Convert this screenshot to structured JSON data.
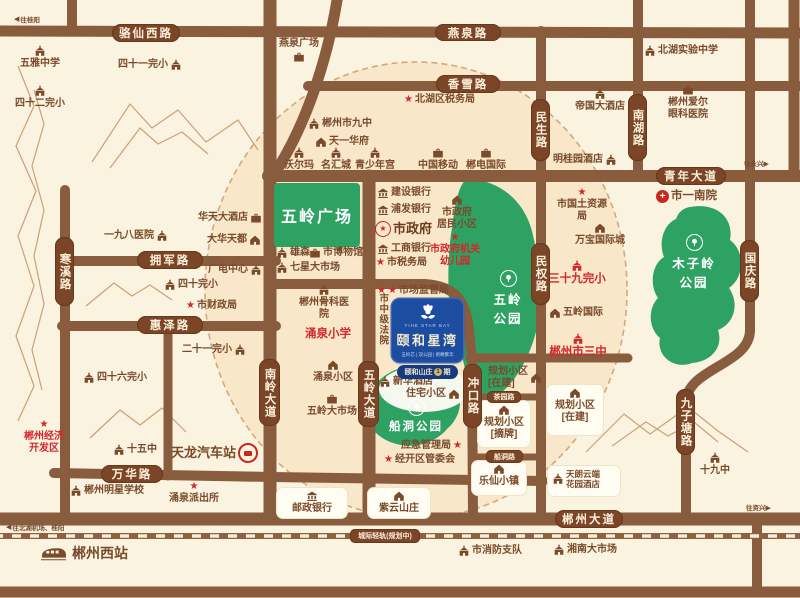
{
  "colors": {
    "background": "#f9f3df",
    "inner_circle": "#f8e7c9",
    "road": "#8a5c3e",
    "road_pill": "#7b4527",
    "park_green": "#2ea263",
    "accent_red": "#d3272a",
    "brand_blue": "#1d4da0",
    "badge_blue": "#163a7f",
    "gold": "#d9b35e",
    "brown_text": "#7a4a2b"
  },
  "logo": {
    "en": "YIHE STAR BAY",
    "name": "颐和星湾",
    "tagline": "五岭芯 | 双公园 | 俯瞰繁华",
    "estate": "颐和山庄",
    "phase_no": "1",
    "phase_word": "期",
    "flower_icon": "magnolia-flower-icon"
  },
  "roads": {
    "luoxianxi": "骆仙西路",
    "yanquan": "燕泉路",
    "xiangxue": "香雪路",
    "qingnian": "青年大道",
    "yongjun": "拥军路",
    "huize": "惠泽路",
    "wanhua": "万华路",
    "czdd": "郴州大道",
    "hanxi": "寒溪路",
    "minsheng": "民生路",
    "minquan": "民权路",
    "nanhu": "南湖路",
    "guoqing": "国庆路",
    "nanling": "南岭大道",
    "wulingdd": "五岭大道",
    "chongkou": "冲口路",
    "jiuzitang": "九子塘路",
    "chuandong": "船洞路",
    "chayuan": "茶园路",
    "qinggui": "城际轻轨(规划中)"
  },
  "arrows": {
    "guiyang": "往桂阳",
    "yongxing": "往永兴",
    "zixing": "往资兴",
    "jichang": "往北湖机场、桂阳"
  },
  "parks": {
    "wuling": "五岭\n公园",
    "muziling": "木子岭\n公园",
    "chuandong": "船洞公园",
    "plaza": "五岭广场"
  },
  "pois": {
    "wuyazx": "五雅中学",
    "ss1wx": "四十一完小",
    "ss2wx": "四十二完小",
    "yqgc": "燕泉广场",
    "jiuzhong": "郴州市九中",
    "tyhf": "天一华府",
    "wem": "沃尔玛",
    "mhc": "名汇城",
    "qsng": "青少年宫",
    "zgyd": "中国移动",
    "cdgj": "郴电国际",
    "bhswj": "北湖区税务局",
    "bhsyzx": "北湖实验中学",
    "dgdjd": "帝国大酒店",
    "aeyk": "郴州爱尔\n眼科医院",
    "mgyjd": "明桂园酒店",
    "synY": "市一南院",
    "yjbyy": "一九八医院",
    "htdjd": "华天大酒店",
    "dhtd": "大华天都",
    "gdzx": "广电中心",
    "sswx": "四十完小",
    "sczj": "市财政局",
    "esywx": "二十一完小",
    "sslwx": "四十六完小",
    "xs": "雄森",
    "sbwg": "市博物馆",
    "qxdsc": "七星大市场",
    "jsyh": "建设银行",
    "pfyh": "浦发银行",
    "szf": "市政府",
    "szfjm": "市政府\n居民小区",
    "szfyey": "市政府机关\n幼儿园",
    "gsyh": "工商银行",
    "sswj": "市税务局",
    "scjgj": "市场监管局",
    "szjfy": "市中级法院",
    "czgk": "郴州骨科医院",
    "yqxx": "涌泉小学",
    "yqxq": "涌泉小区",
    "wldsc": "五岭大市场",
    "xhjd": "新华酒店",
    "zzxq": "住宅小区",
    "yjglj": "应急管理局",
    "jkqgwh": "经开区管委会",
    "yzyh": "邮政银行",
    "zysz": "紫云山庄",
    "lxxz": "乐仙小镇",
    "ghzp": "规划小区\n[摘牌]",
    "ghzj1": "规划小区\n[在建]",
    "ghzj2": "规划小区\n[在建]",
    "sgtzyj": "市国土资源局",
    "wbgjc": "万宝国际城",
    "ssjwx": "三十九完小",
    "wlgj": "五岭国际",
    "czssz": "郴州市三中",
    "tlyd": "天朗云端\n花园酒店",
    "sjzhong": "十九中",
    "czjjkfq": "郴州经济\n开发区",
    "swz": "十五中",
    "tlqcz": "天龙汽车站",
    "czmxxx": "郴州明星学校",
    "yqpcs": "涌泉派出所",
    "czxz": "郴州西站",
    "sxfzd": "市消防支队",
    "xndsc": "湘南大市场"
  }
}
